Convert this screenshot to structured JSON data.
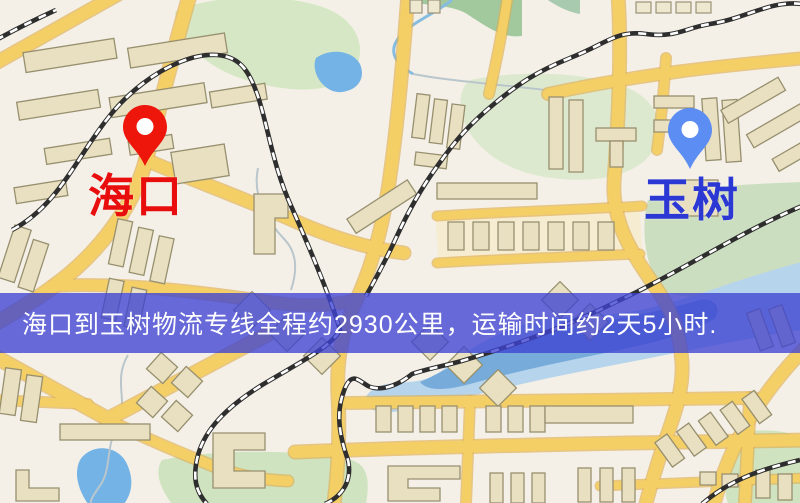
{
  "banner": {
    "text": "海口到玉树物流专线全程约2930公里，运输时间约2天5小时.",
    "background_color": "rgba(62,66,210,0.78)",
    "text_color": "#ffffff"
  },
  "markers": {
    "origin": {
      "label": "海口",
      "pin_color": "#ee150b",
      "label_color": "#e80e0e"
    },
    "destination": {
      "label": "玉树",
      "pin_color": "#5c8df2",
      "label_color": "#2b38d4"
    }
  },
  "map_palette": {
    "background": "#f4f0e7",
    "road": "#f4cf66",
    "road_casing": "#dfae52",
    "street_band": "#f5ecd2",
    "building": "#e9dfc1",
    "building_outline": "#97906f",
    "park": "#d6e7c5",
    "forest": "#a2c89e",
    "water": "#74b3e6",
    "river_pale": "#b6d4ec",
    "river_deep": "#68a0d6",
    "railway": "#2e2e2e"
  }
}
